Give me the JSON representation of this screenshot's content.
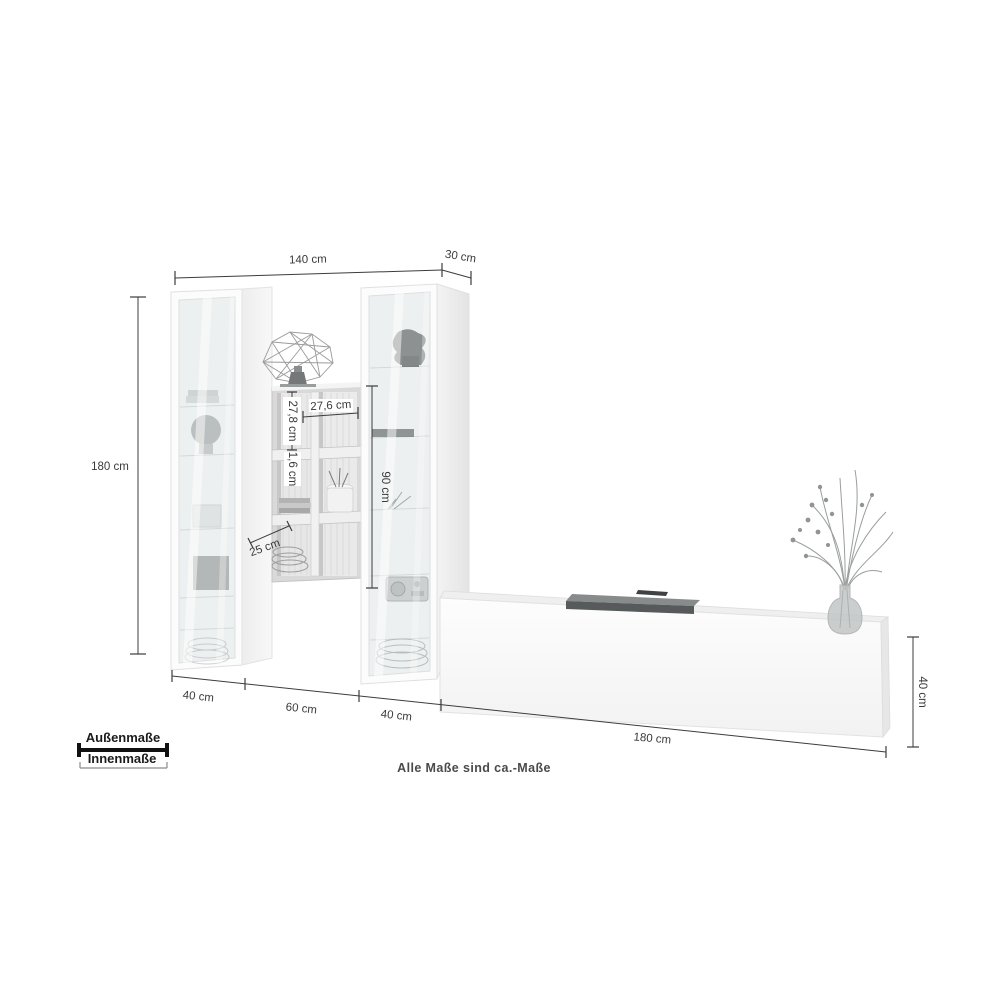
{
  "title": "Wohnwand Maßzeichnung",
  "note": "Alle Maße sind ca.-Maße",
  "legend": {
    "outer_label": "Außenmaße",
    "inner_label": "Innenmaße"
  },
  "labels": {
    "width_total": "140 cm",
    "depth": "30 cm",
    "height_total": "180 cm",
    "shelf_inner_height": "27,8 cm",
    "shelf_inner_width": "27,6 cm",
    "panel_thickness": "1,6 cm",
    "vitrine_inner_height": "90 cm",
    "shelf_depth": "25 cm",
    "vitrine_left_width": "40 cm",
    "shelf_unit_width": "60 cm",
    "vitrine_right_width": "40 cm",
    "lowboard_length": "180 cm",
    "lowboard_height": "40 cm"
  },
  "colors": {
    "dimension_line": "#3c3c3c",
    "dimension_text": "#3a3a3a",
    "legend_outer_line": "#111111",
    "legend_inner_line": "#8c8c8c",
    "furniture_white": "#fcfcfc",
    "glass": "#edf0f0",
    "background": "#ffffff"
  }
}
